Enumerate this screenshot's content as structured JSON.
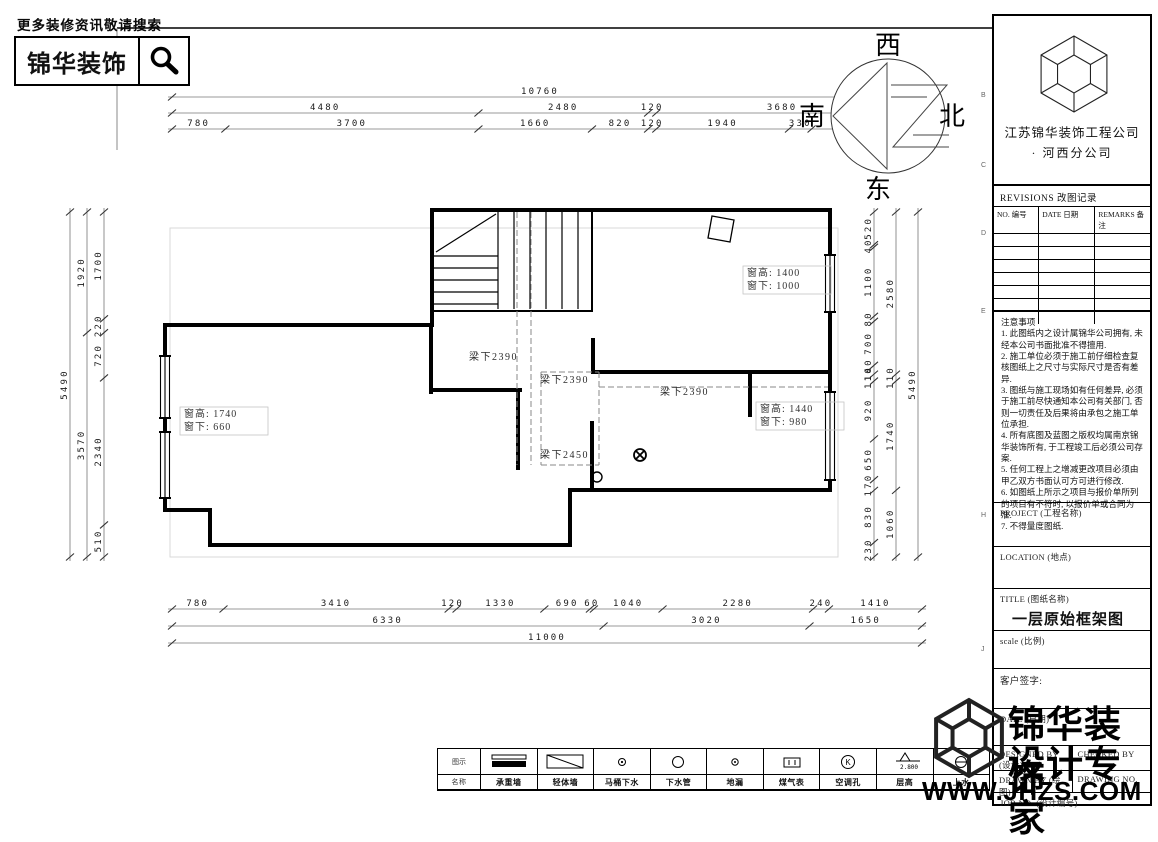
{
  "sheet": {
    "slogan": "更多装修资讯敬请搜索",
    "brand": "锦华装饰"
  },
  "compass": {
    "top": "西",
    "right": "北",
    "bottom": "东",
    "left": "南"
  },
  "plan": {
    "beam_labels": [
      {
        "text": "梁下2390",
        "x": 469,
        "y": 360
      },
      {
        "text": "梁下2390",
        "x": 540,
        "y": 383
      },
      {
        "text": "梁下2390",
        "x": 660,
        "y": 395
      },
      {
        "text": "梁下2450",
        "x": 540,
        "y": 458
      }
    ],
    "window_labels": [
      {
        "line1": "窗高: 1740",
        "line2": "窗下: 660",
        "x": 184,
        "y": 417
      },
      {
        "line1": "窗高: 1400",
        "line2": "窗下: 1000",
        "x": 747,
        "y": 276
      },
      {
        "line1": "窗高: 1440",
        "line2": "窗下: 980",
        "x": 760,
        "y": 412
      }
    ],
    "dimensions": {
      "top": {
        "x0": 172,
        "x1": 908,
        "rows": [
          {
            "y": 97,
            "values": [
              10760
            ]
          },
          {
            "y": 113,
            "values": [
              4480,
              2480,
              120,
              3680
            ]
          },
          {
            "y": 129,
            "values": [
              780,
              3700,
              1660,
              820,
              120,
              1940,
              330,
              1410
            ]
          }
        ]
      },
      "bottom": {
        "x0": 172,
        "x1": 922,
        "rows": [
          {
            "y": 609,
            "values": [
              780,
              3410,
              120,
              1330,
              690,
              60,
              1040,
              2280,
              240,
              1410
            ]
          },
          {
            "y": 626,
            "values": [
              6330,
              3020,
              1650
            ]
          },
          {
            "y": 643,
            "values": [
              11000
            ]
          }
        ]
      },
      "left": {
        "y0": 212,
        "y1": 557,
        "cols": [
          {
            "x": 70,
            "values": [
              5490
            ]
          },
          {
            "x": 87,
            "values": [
              1920,
              3570
            ]
          },
          {
            "x": 104,
            "values": [
              1700,
              220,
              720,
              2340,
              510
            ]
          }
        ]
      },
      "right": {
        "y0": 212,
        "y1": 557,
        "cols": [
          {
            "x": 874,
            "values": [
              520,
              40,
              1100,
              80,
              700,
              140,
              110,
              920,
              650,
              170,
              830,
              230
            ]
          },
          {
            "x": 896,
            "values": [
              2580,
              110,
              1740,
              1060
            ]
          },
          {
            "x": 918,
            "values": [
              5490
            ]
          }
        ]
      }
    }
  },
  "legend": {
    "row_headers": [
      "图示",
      "名称"
    ],
    "items": [
      {
        "symbol": "wall-solid",
        "name": "承重墙"
      },
      {
        "symbol": "wall-hatch",
        "name": "轻体墙"
      },
      {
        "symbol": "toilet-drain",
        "name": "马桶下水"
      },
      {
        "symbol": "drain-pipe",
        "name": "下水管"
      },
      {
        "symbol": "floor-drain",
        "name": "地漏"
      },
      {
        "symbol": "gas-meter",
        "name": "煤气表"
      },
      {
        "symbol": "ac-hole",
        "name": "空调孔"
      },
      {
        "symbol": "level-mark",
        "name": "层高",
        "value": "2.800"
      },
      {
        "symbol": "water-supply",
        "name": "上水"
      }
    ]
  },
  "title_block": {
    "company": {
      "name": "江苏锦华装饰工程公司",
      "bullet": "·",
      "branch": "河西分公司"
    },
    "revisions": {
      "title": "REVISIONS 改图记录",
      "columns": [
        "NO. 编号",
        "DATE 日期",
        "REMARKS 备注"
      ],
      "empty_rows": 7
    },
    "notes": {
      "title": "注意事项",
      "items": [
        "1. 此图纸内之设计属锦华公司拥有, 未经本公司书面批准不得擅用.",
        "2. 施工单位必须于施工前仔细检查复核图纸上之尺寸与实际尺寸是否有差异.",
        "3. 图纸与施工现场如有任何差异, 必须于施工前尽快通知本公司有关部门, 否则一切责任及后果将由承包之施工单位承担.",
        "4. 所有底图及蓝图之版权均属南京锦华装饰所有, 于工程竣工后必须公司存案.",
        "5. 任何工程上之增减更改项目必须由甲乙双方书面认可方可进行修改.",
        "6. 如图纸上所示之项目与报价单所列的项目有不符时, 以报价单或合同为准.",
        "7. 不得量度图纸."
      ]
    },
    "fields": {
      "project_label": "PROJECT (工程名称)",
      "location_label": "LOCATION (地点)",
      "title_label": "TITLE (图纸名称)",
      "drawing_title": "一层原始框架图",
      "scale_label": "scale (比例)",
      "client_sign_label": "客户签字:",
      "date_label": "DATE (日期)",
      "designed_by_label": "DESIGNED BY (设计)",
      "checked_by_label": "CHECKED BY",
      "drawn_by_label": "DRAWN BY (绘图)",
      "drawing_no_label": "DRAWING NO.",
      "job_no_label": "JOB NO. (设计编号)"
    },
    "zone_letters": [
      "B",
      "C",
      "D",
      "E",
      "H",
      "J"
    ]
  },
  "watermark": {
    "line1": "锦华装饰",
    "line2": "设计专家",
    "url": "WWW.JHZS.COM"
  }
}
